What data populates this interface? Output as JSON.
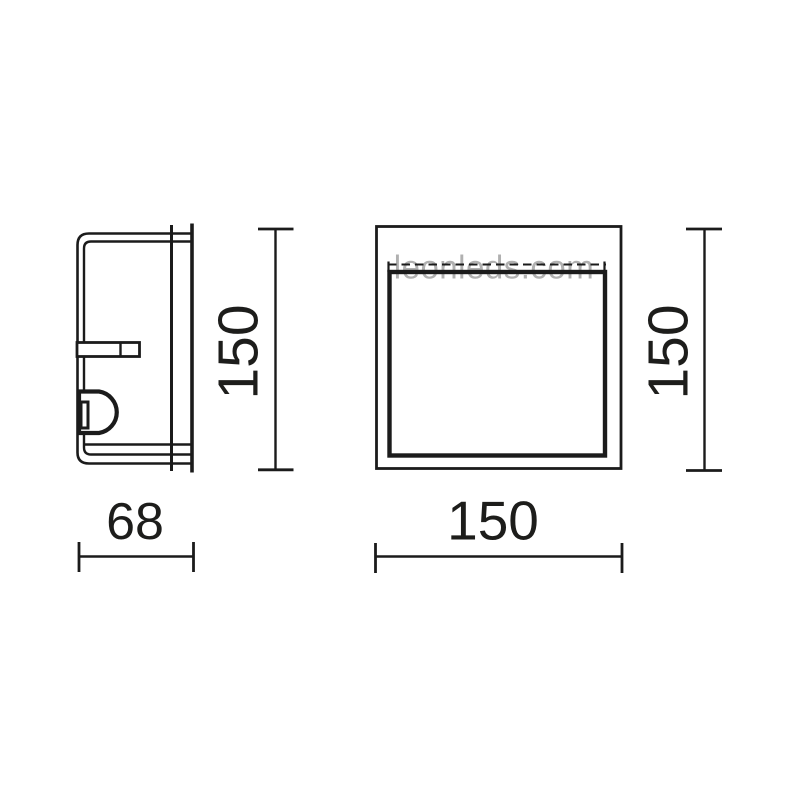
{
  "page": {
    "background": "#ffffff",
    "drawing_type": "technical-dimension-drawing"
  },
  "colors": {
    "line": "#1b1b1b",
    "text": "#1d1d1b",
    "watermark": "#b0b0b0"
  },
  "watermark": {
    "text": "leonleds.com"
  },
  "dimensions": {
    "side_view": {
      "height": "150",
      "depth": "68"
    },
    "front_view": {
      "height": "150",
      "width": "150"
    }
  }
}
